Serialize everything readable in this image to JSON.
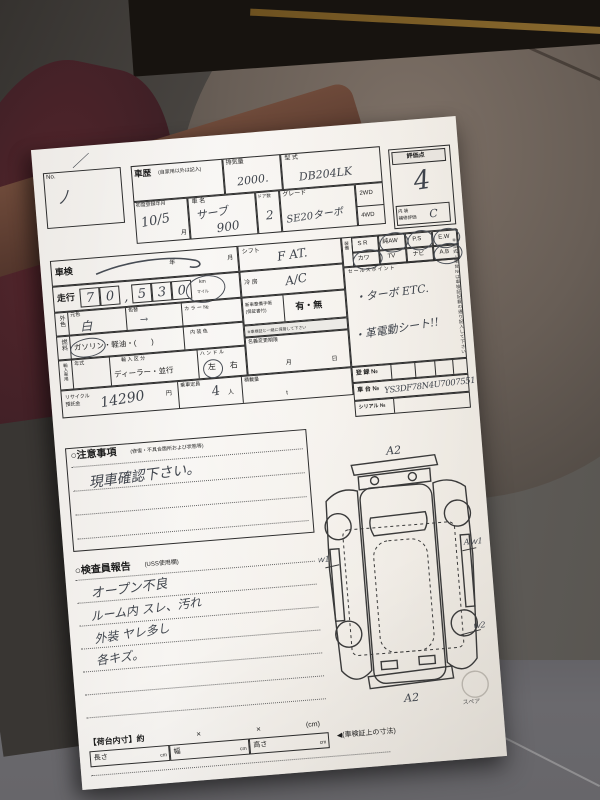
{
  "photo": {
    "corner_tick": "／",
    "side_note": "※型式・車台№は車検証記載の通り記入して下さい"
  },
  "no_box": {
    "label": "No.",
    "value": "ノ"
  },
  "header": {
    "history_label": "車歴",
    "history_sub": "(自家用以外は記入)",
    "displacement_label": "排気量",
    "displacement_value": "2000.",
    "model_label": "型  式",
    "model_value": "DB204LK",
    "score_label": "評価点",
    "score_value": "4",
    "interior_label1": "内 装",
    "interior_label2": "補修評価",
    "interior_value": "C",
    "first_reg_label": "初度登録年月",
    "first_reg_value": "10/5",
    "first_reg_unit": "月",
    "name_label": "車  名",
    "name_value": "サーブ",
    "name_value2": "900",
    "doors_label": "ドア数",
    "doors_value": "2",
    "grade_label": "グレード",
    "grade_value": "SE20ターボ",
    "wd2": "2WD",
    "wd4": "4WD"
  },
  "rows": {
    "shaken_label": "車検",
    "shaken_year_unit": "年",
    "shaken_month_unit": "月",
    "mileage_label": "走行",
    "mileage_digits": [
      "7",
      "0",
      ",",
      "5",
      "3",
      "0"
    ],
    "unit_km": "km",
    "unit_mile": "マイル",
    "color_label": "外色",
    "color_orig_label": "元色",
    "color_orig_value": "白",
    "color_change_label": "色替",
    "color_change_value": "→",
    "color_no_label": "カ ラ ー №",
    "fuel_label": "燃料",
    "fuel_value": "ガソリン・軽油・(　　)",
    "interior_color_label": "内 装 色",
    "import_label": "輸入車用",
    "year_label": "年式",
    "import_class_label": "輸 入 区 分",
    "import_class_value": "ディーラー・並行",
    "handle_label": "ハ ン ド ル",
    "handle_left": "左",
    "handle_right": "右",
    "recycle_label1": "リサイクル",
    "recycle_label2": "預託金",
    "recycle_value": "14290",
    "recycle_unit": "円",
    "capacity_label": "乗車定員",
    "capacity_value": "4",
    "capacity_unit": "人",
    "load_label": "積載量",
    "load_unit": "t"
  },
  "middle": {
    "shift_label": "シフト",
    "shift_value": "F AT.",
    "cool_label": "冷 房",
    "cool_value": "A/C",
    "warranty_label": "新車整備手帳",
    "warranty_sub": "(保証書付)",
    "warranty_value": "有・無",
    "warranty_note": "※車検証と一緒に保管して下さい",
    "transfer_label": "名義変更期限",
    "transfer_month": "月",
    "transfer_day": "日"
  },
  "equipment": {
    "label": "装備",
    "row1": [
      "S R",
      "純AW",
      "P.S",
      "E.W"
    ],
    "row2": [
      "カワ",
      "TV",
      "ナビ",
      "A.B"
    ],
    "sales_label": "セールスポイント",
    "sales_line1": "・ターボ  ETC.",
    "sales_line2": "・革電動シート!!"
  },
  "registration": {
    "reg_label": "登 録 №",
    "chassis_label": "車 台 №",
    "chassis_value": "YS3DF78N4U7007551",
    "serial_label": "シリアル №"
  },
  "notes": {
    "title": "○注意事項",
    "sub": "(修復・不具合箇所および状態等)",
    "line1": "現車確認下さい。"
  },
  "inspector": {
    "title": "○検査員報告",
    "sub": "(USS使用欄)",
    "lines": [
      "オープン不良",
      "ルーム内 スレ、汚れ",
      "外装 ヤレ多し",
      "各キズ。"
    ]
  },
  "diagram": {
    "a2_top": "A2",
    "a2_bottom": "A2",
    "w1_left": "ｗ1",
    "w1_right": "Aｗ1",
    "w2_right": "ｗ2",
    "spare_label": "スペア"
  },
  "cargo": {
    "title": "【荷台内寸】約",
    "x1": "×",
    "x2": "×",
    "unit": "(cm)",
    "len_label": "長さ",
    "wid_label": "幅",
    "hei_label": "高さ",
    "cm": "cm",
    "note": "◀(車検証上の寸法)"
  }
}
